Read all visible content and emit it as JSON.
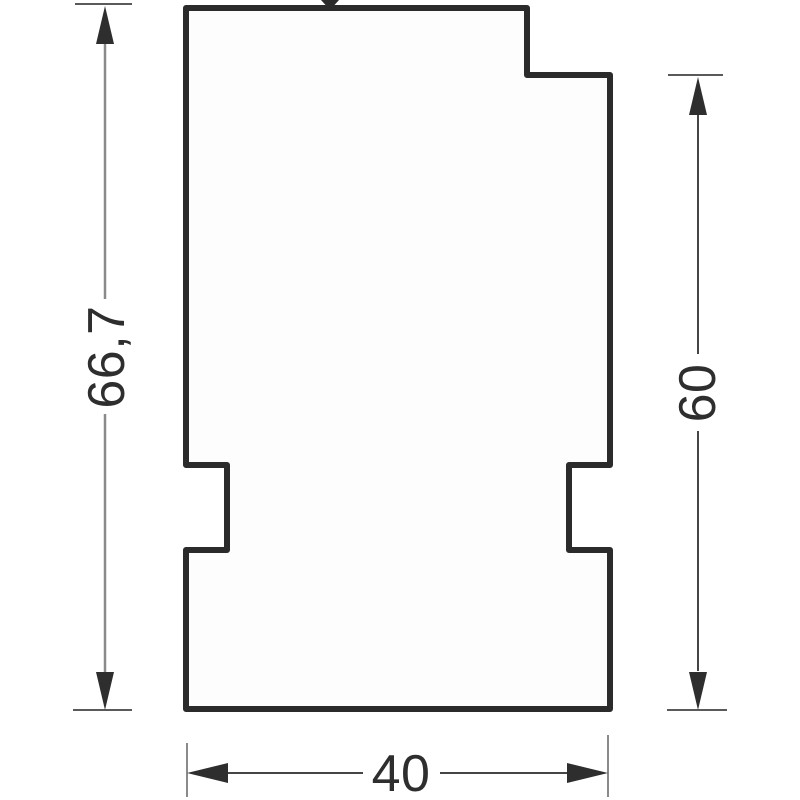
{
  "drawing": {
    "part": {
      "outline_points": "186,8 527,8 527,75 610,75 610,465 569,465 569,550 610,550 610,709 186,709 186,550 227,550 227,465 186,465",
      "fill": "#fdfdfd"
    },
    "dimensions": {
      "left_height": {
        "label": "66,7"
      },
      "right_height": {
        "label": "60"
      },
      "bottom_width": {
        "label": "40"
      }
    },
    "colors": {
      "outline": "#2b2b2b",
      "dim_line_light": "#8a8a8a",
      "dim_line_dark": "#454545",
      "extension_line": "#5a5a5a",
      "extension_line_light": "#8a8a8a",
      "arrow": "#2e2e2e",
      "text": "#2e2e2e",
      "background": "#ffffff"
    }
  }
}
